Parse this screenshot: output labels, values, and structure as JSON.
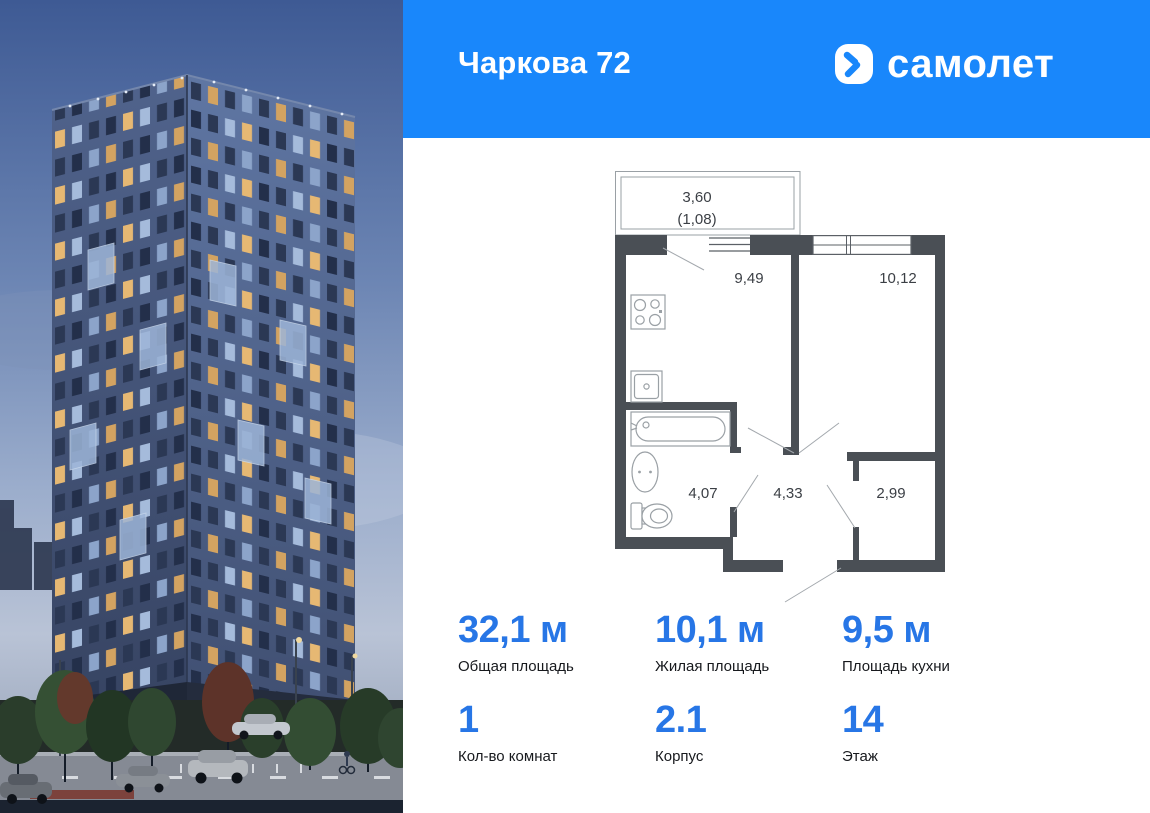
{
  "header": {
    "title": "Чаркова 72",
    "brand": "самолет"
  },
  "plan": {
    "balcony": "3,60",
    "balcony_reduced": "(1,08)",
    "kitchen": "9,49",
    "bedroom": "10,12",
    "bathroom": "4,07",
    "hallway": "4,33",
    "wardrobe": "2,99"
  },
  "stats": {
    "items": [
      {
        "value": "32,1 м",
        "label": "Общая площадь"
      },
      {
        "value": "10,1 м",
        "label": "Жилая площадь"
      },
      {
        "value": "9,5 м",
        "label": "Площадь кухни"
      },
      {
        "value": "1",
        "label": "Кол-во комнат"
      },
      {
        "value": "2.1",
        "label": "Корпус"
      },
      {
        "value": "14",
        "label": "Этаж"
      }
    ]
  },
  "colors": {
    "header_blue": "#1987fb",
    "stat_number_blue": "#2776e6",
    "plan_wall_gray": "#4a4f55"
  },
  "icons": {
    "brand_icon": "samolet-chevron"
  }
}
